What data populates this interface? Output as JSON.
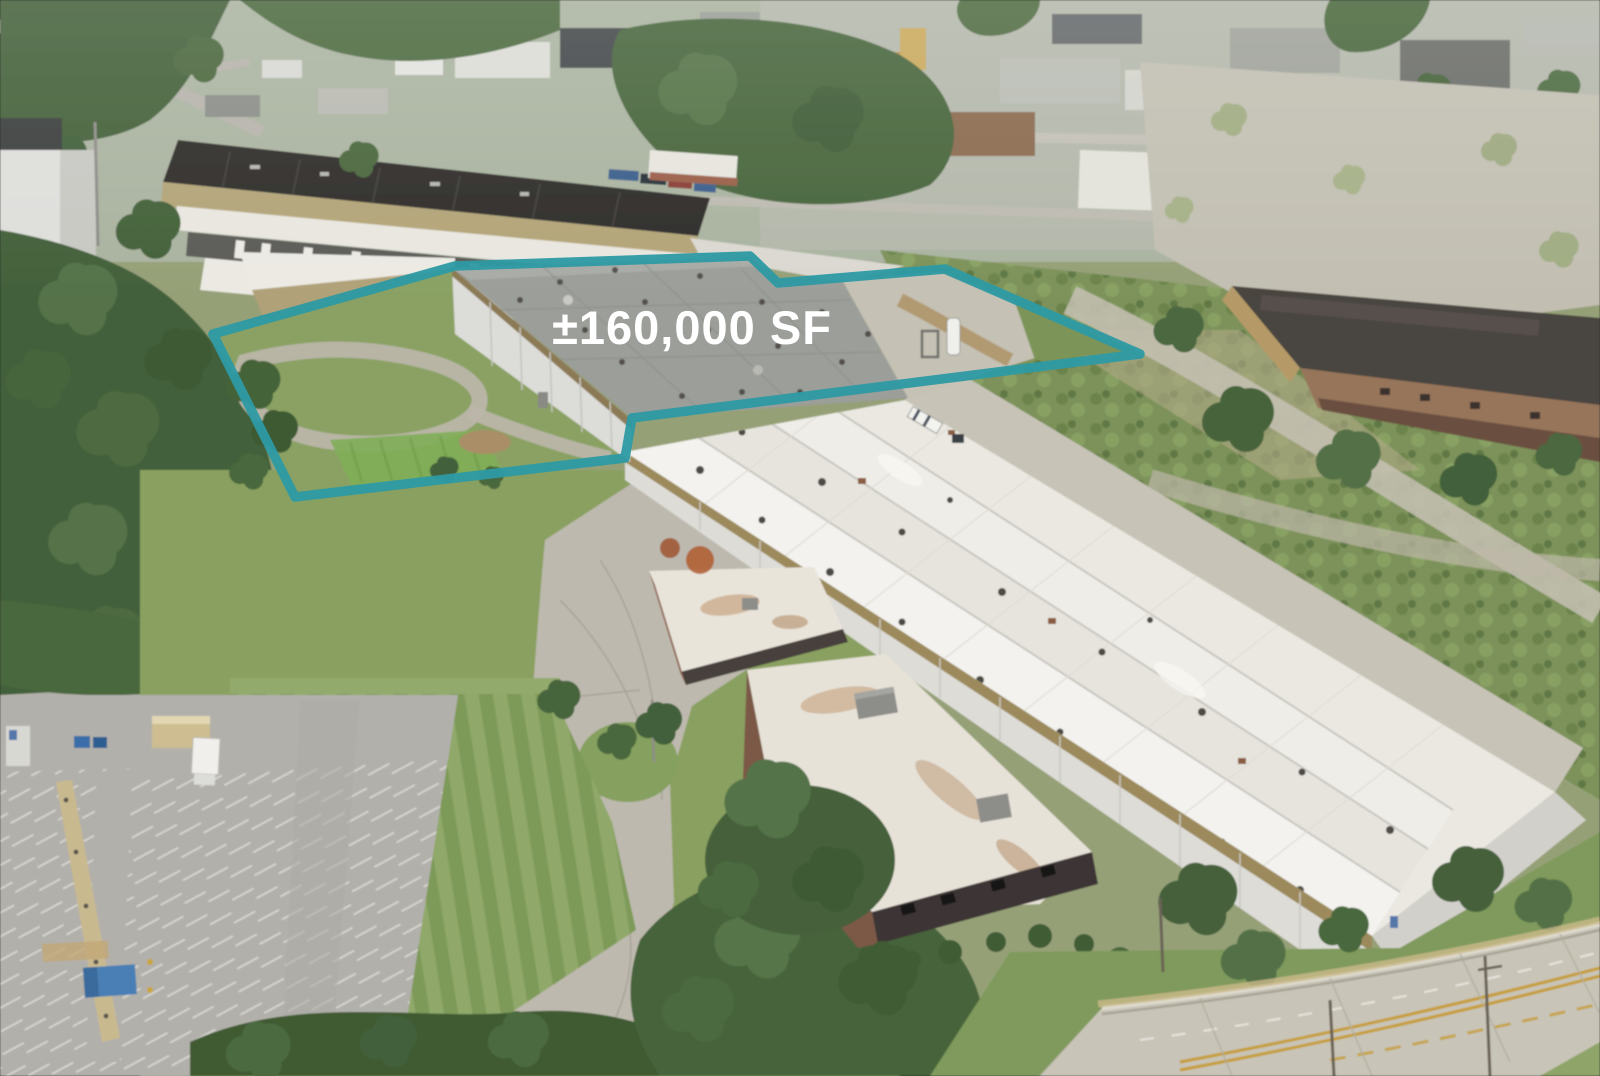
{
  "overlay": {
    "area_label": "±160,000 SF",
    "outline_color": "#2D9AA4",
    "label_color": "#FFFFFF"
  },
  "palette": {
    "teal_accent": "#2D9AA4",
    "roof_white": "#EAE8E1",
    "roof_gray": "#9B9E99",
    "dark_roof": "#2F2D2A",
    "tan_wall": "#B3A478",
    "tree_green": "#4F6A3E",
    "lawn_green": "#85A061",
    "pavement_gray": "#BDBAAF",
    "road_concrete": "#C8C4B7",
    "road_line_yellow": "#C79F3E"
  }
}
